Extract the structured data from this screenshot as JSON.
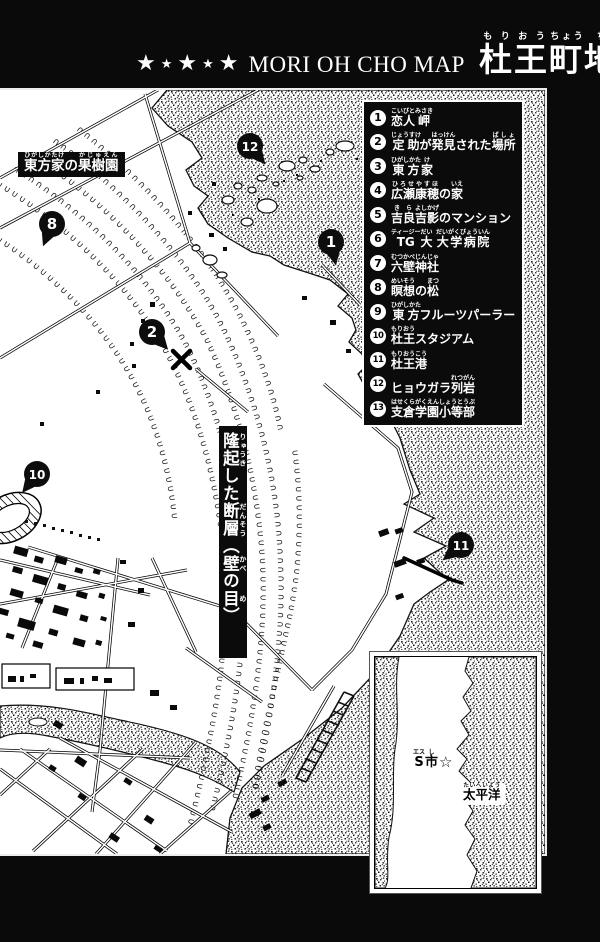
{
  "header": {
    "stars": [
      "★",
      "★",
      "★",
      "★",
      "★"
    ],
    "title_en": "MORI OH CHO MAP",
    "title_jp": [
      [
        "杜",
        "もり"
      ],
      [
        "王",
        "おう"
      ],
      [
        "町",
        "ちょう"
      ],
      [
        "地",
        "ち"
      ],
      [
        "図",
        "ず"
      ]
    ]
  },
  "legend": {
    "items": [
      {
        "n": "1",
        "segs": [
          [
            "恋人",
            "こいびと"
          ],
          [
            "岬",
            "みさき"
          ]
        ]
      },
      {
        "n": "2",
        "segs": [
          [
            "定助",
            "じょうすけ"
          ],
          [
            "が",
            ""
          ],
          [
            "発見",
            "はっけん"
          ],
          [
            "された",
            ""
          ],
          [
            "場所",
            "ばしょ"
          ]
        ]
      },
      {
        "n": "3",
        "segs": [
          [
            "東方",
            "ひがしかた"
          ],
          [
            "家",
            "け"
          ]
        ]
      },
      {
        "n": "4",
        "segs": [
          [
            "広瀬",
            "ひろせ"
          ],
          [
            "康穂",
            "やすほ"
          ],
          [
            "の",
            ""
          ],
          [
            "家",
            "いえ"
          ]
        ]
      },
      {
        "n": "5",
        "segs": [
          [
            "吉良",
            "きら"
          ],
          [
            "吉影",
            "よしかげ"
          ],
          [
            "のマンション",
            ""
          ]
        ]
      },
      {
        "n": "6",
        "segs": [
          [
            "TG",
            "ティージー"
          ],
          [
            "大",
            "だい"
          ],
          [
            " ",
            ""
          ],
          [
            "大学病院",
            "だいがくびょういん"
          ]
        ]
      },
      {
        "n": "7",
        "segs": [
          [
            "六壁",
            "むつかべ"
          ],
          [
            "神社",
            "じんじゃ"
          ]
        ]
      },
      {
        "n": "8",
        "segs": [
          [
            "瞑想",
            "めいそう"
          ],
          [
            "の",
            ""
          ],
          [
            "松",
            "まつ"
          ]
        ]
      },
      {
        "n": "9",
        "segs": [
          [
            "東方",
            "ひがしかた"
          ],
          [
            "フルーツパーラー",
            ""
          ]
        ]
      },
      {
        "n": "10",
        "segs": [
          [
            "杜王",
            "もりおう"
          ],
          [
            "スタジアム",
            ""
          ]
        ]
      },
      {
        "n": "11",
        "segs": [
          [
            "杜王",
            "もりおう"
          ],
          [
            "港",
            "こう"
          ]
        ]
      },
      {
        "n": "12",
        "segs": [
          [
            "ヒョウガラ",
            ""
          ],
          [
            "列岩",
            "れつがん"
          ]
        ]
      },
      {
        "n": "13",
        "segs": [
          [
            "支倉",
            "はせくら"
          ],
          [
            "学園",
            "がくえん"
          ],
          [
            "小等部",
            "しょうとうぶ"
          ]
        ]
      }
    ]
  },
  "map": {
    "orchard_label": {
      "segs": [
        [
          "東方家",
          "ひがしかたけ"
        ],
        [
          "の",
          ""
        ],
        [
          "果樹園",
          "かじゅえん"
        ]
      ]
    },
    "fault_label": {
      "segs": [
        [
          "隆起",
          "りゅうき"
        ],
        [
          "した",
          ""
        ],
        [
          "断層",
          "だんそう"
        ],
        [
          "（",
          ""
        ],
        [
          "壁",
          "かべ"
        ],
        [
          "の",
          ""
        ],
        [
          "目",
          "め"
        ],
        [
          "）",
          ""
        ]
      ]
    },
    "markers": [
      {
        "n": "12",
        "x": 250,
        "y": 56,
        "a": 50
      },
      {
        "n": "8",
        "x": 52,
        "y": 134,
        "a": 112
      },
      {
        "n": "1",
        "x": 331,
        "y": 152,
        "a": 78
      },
      {
        "n": "2",
        "x": 152,
        "y": 242,
        "a": 48
      },
      {
        "n": "10",
        "x": 37,
        "y": 384,
        "a": 128
      },
      {
        "n": "11",
        "x": 461,
        "y": 455,
        "a": 140
      }
    ]
  },
  "inset": {
    "city": {
      "segs": [
        [
          "S",
          "エス"
        ],
        [
          "市",
          "し"
        ]
      ]
    },
    "star": "☆",
    "ocean": {
      "segs": [
        [
          "太平洋",
          "たいへいよう"
        ]
      ]
    }
  },
  "colors": {
    "page_bg": "#0a0a0a",
    "panel_bg": "#ffffff",
    "ink": "#000000",
    "text": "#ffffff"
  }
}
